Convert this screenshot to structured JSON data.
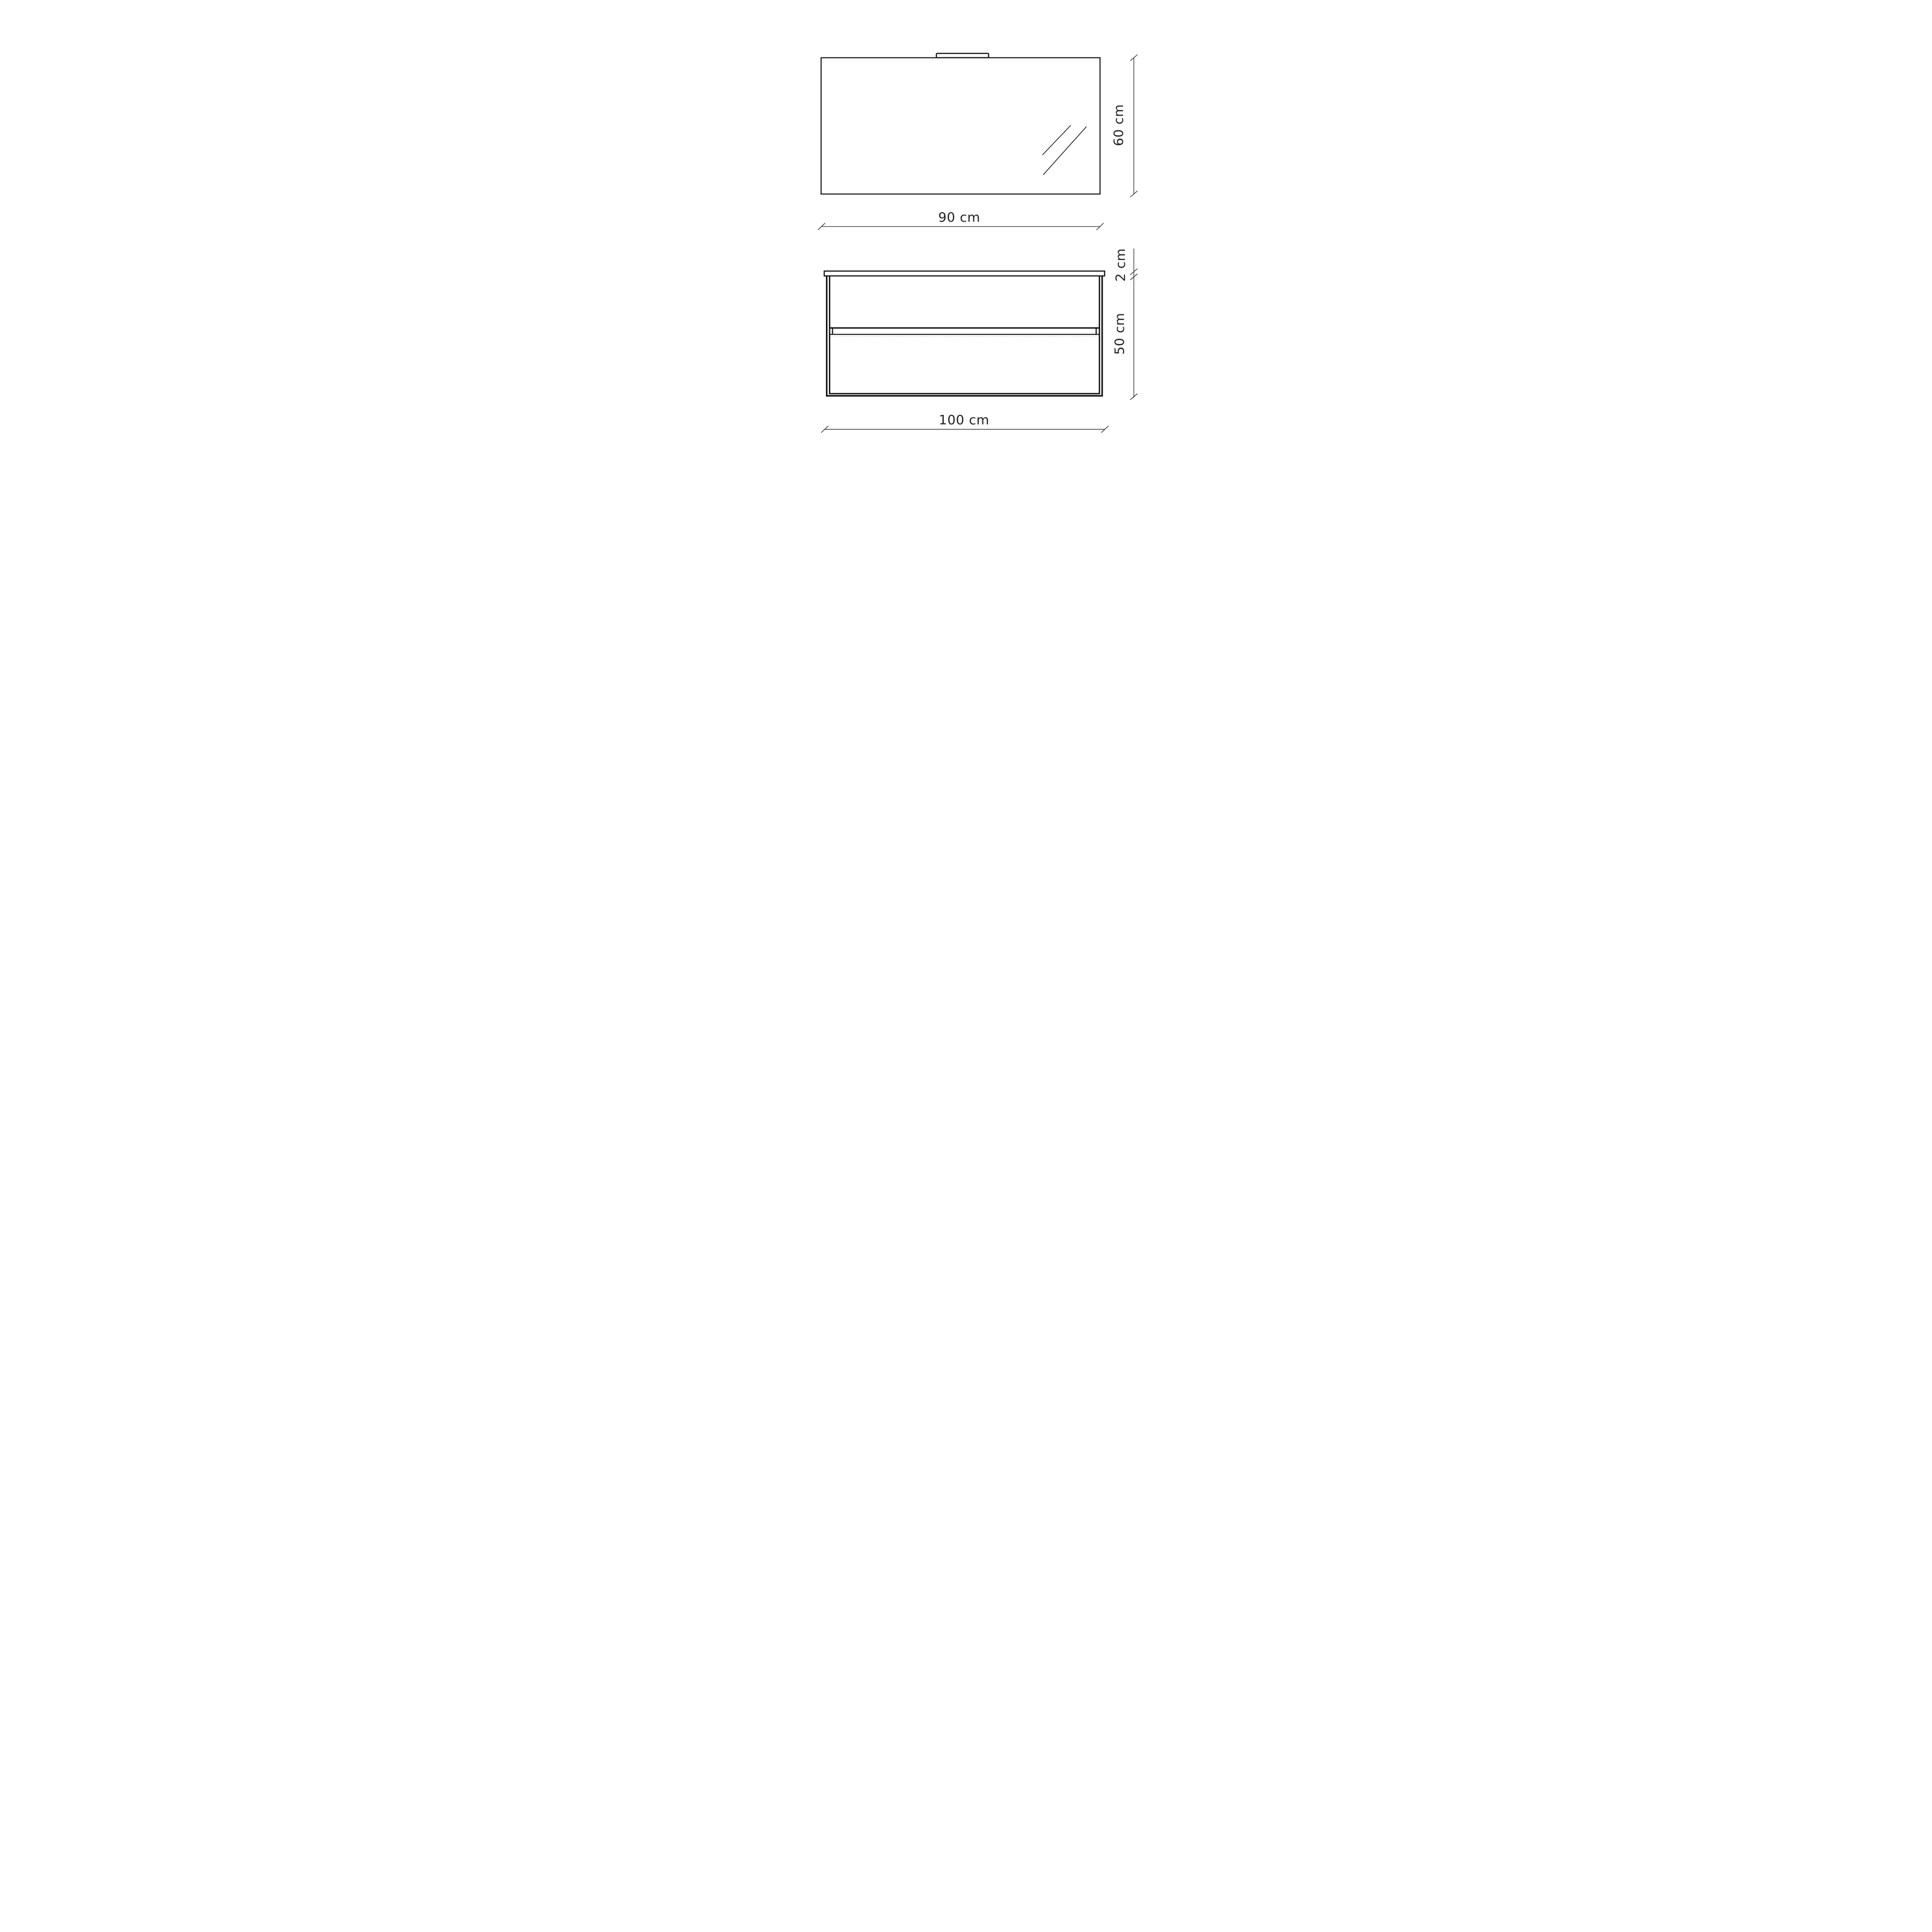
{
  "theme": {
    "line_color": "#141414",
    "dim_color": "#2e2e2e",
    "text_color": "#222222",
    "faint_color": "#c4c4c4",
    "background": "#ffffff"
  },
  "drawing": {
    "mirror": {
      "width_label": "90 cm",
      "height_label": "60 cm"
    },
    "vanity": {
      "top_thickness_label": "2 cm",
      "height_label": "50 cm",
      "width_label": "100 cm"
    }
  }
}
